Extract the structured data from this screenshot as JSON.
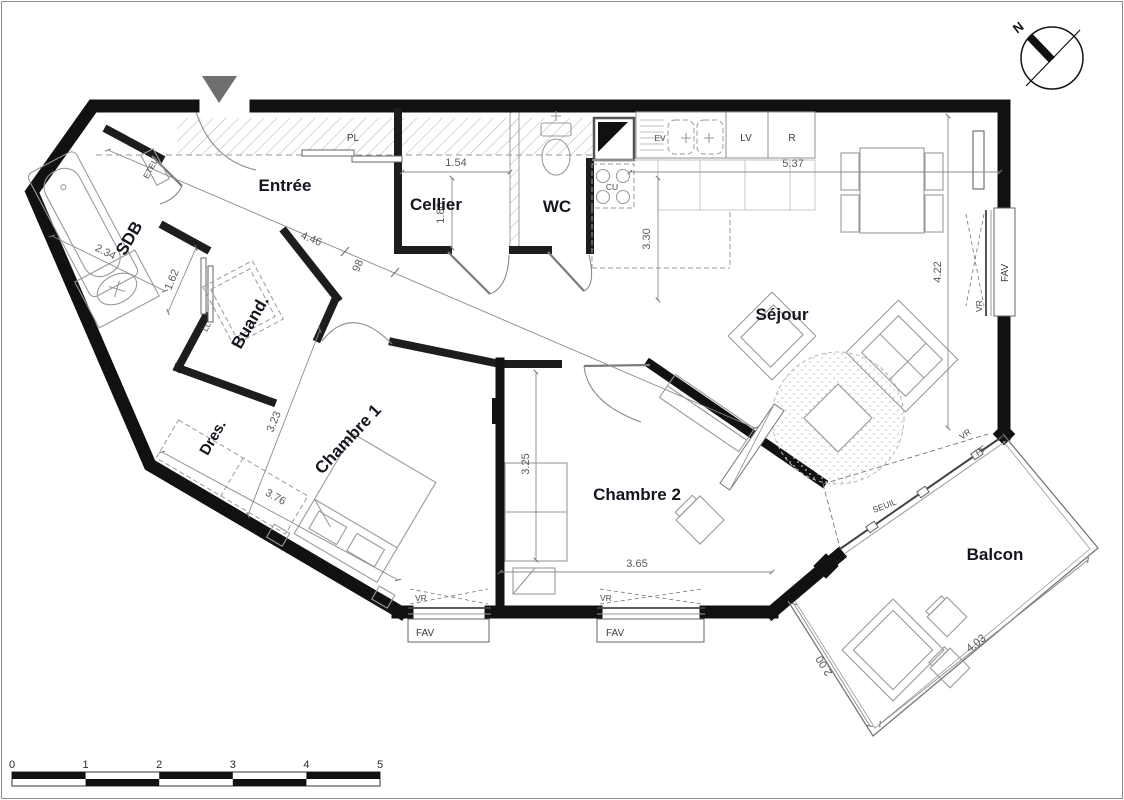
{
  "north": {
    "label": "N"
  },
  "rooms": {
    "entree": "Entrée",
    "cellier": "Cellier",
    "wc": "WC",
    "sdb": "SDB",
    "buand": "Buand.",
    "dres": "Dres.",
    "chambre1": "Chambre 1",
    "chambre2": "Chambre 2",
    "sejour": "Séjour",
    "balcon": "Balcon"
  },
  "fixtures": {
    "etel": "ETEL",
    "pl": "PL",
    "ll": "LL",
    "cu": "CU",
    "ev": "EV",
    "lv": "LV",
    "r": "R",
    "seuil": "SEUIL",
    "pf": "PF"
  },
  "windows": {
    "vr": "VR",
    "fav": "FAV"
  },
  "dimensions": {
    "sdb_width": "2.34",
    "sdb_depth": "1.62",
    "entree_diag": "4.46",
    "hall_width": "98",
    "cellier_width": "1.54",
    "cellier_depth": "1.80",
    "kitchen_sejour_width": "5.37",
    "kitchen_depth": "3.30",
    "sejour_height": "4.22",
    "chambre1_width": "3.23",
    "chambre1_length": "3.76",
    "chambre2_depth": "3.25",
    "chambre2_width": "3.65",
    "balcon_length": "4.03",
    "balcon_depth": "2.00"
  },
  "scale_bar": {
    "ticks": [
      "0",
      "1",
      "2",
      "3",
      "4",
      "5"
    ]
  },
  "colors": {
    "wall": "#111111",
    "room_label": "#14161f",
    "dim_text": "#5a5a5a",
    "furniture_line": "#9a9a9a",
    "hatch": "#b8b8b8"
  }
}
